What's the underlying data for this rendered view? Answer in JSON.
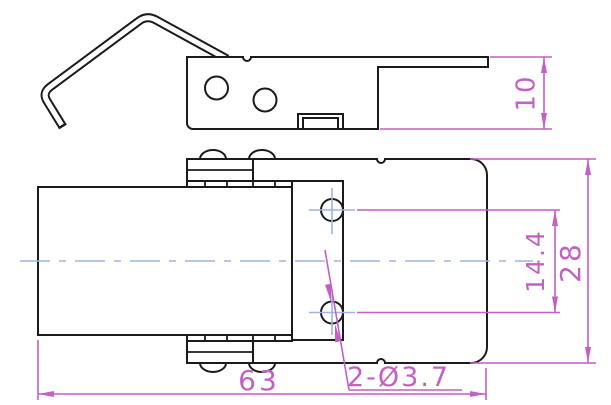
{
  "drawing": {
    "type": "engineering-drawing",
    "subject": "spring-loaded toggle latch / draw catch, two orthographic views",
    "background_color": "#ffffff",
    "outline_color": "#1b1b1b",
    "dimension_color": "#c45fc4",
    "centerline_color": "#9db3e3"
  },
  "dimensions": {
    "plate_height": {
      "label": "10",
      "orientation": "vertical-rotated"
    },
    "hole_spacing": {
      "label": "14.4",
      "orientation": "vertical-rotated"
    },
    "body_width": {
      "label": "28",
      "orientation": "vertical-rotated"
    },
    "overall_length": {
      "label": "63",
      "orientation": "horizontal"
    },
    "hole_callout": {
      "label": "2-Ø3.7",
      "orientation": "horizontal-leader"
    }
  }
}
